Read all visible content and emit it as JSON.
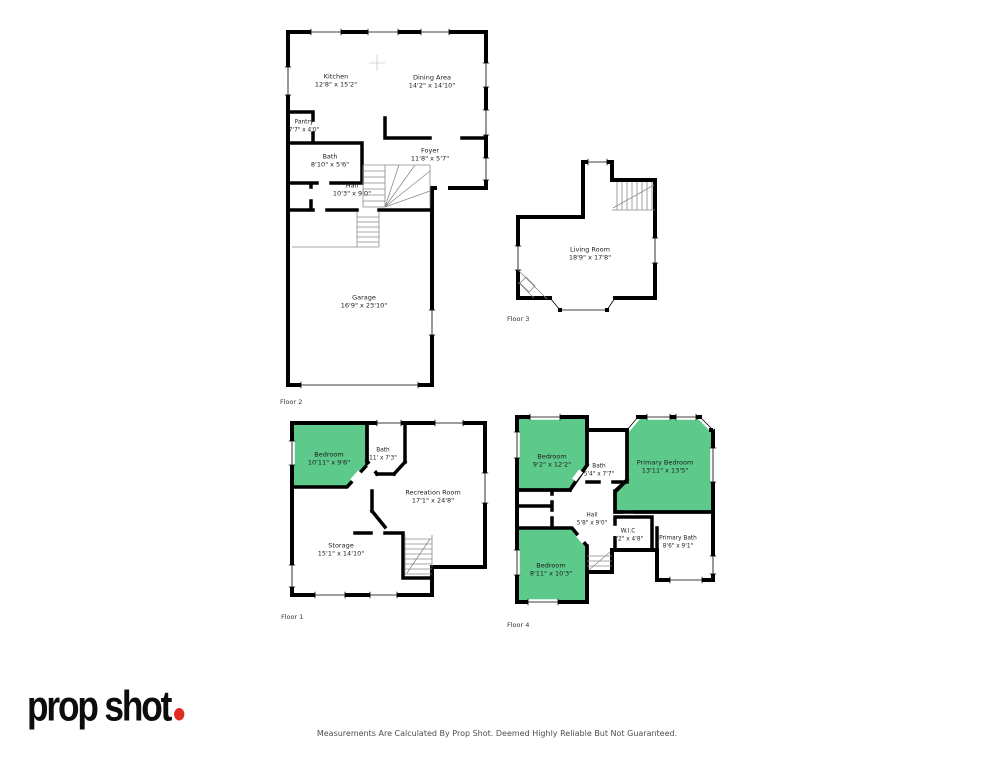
{
  "branding": {
    "logo": "prop shot",
    "dot_color": "#e02b22"
  },
  "footer": {
    "disclaimer": "Measurements Are Calculated By Prop Shot. Deemed Highly Reliable But Not Guaranteed."
  },
  "colors": {
    "room_highlight_green": "#5dc98a",
    "wall": "#000000"
  },
  "floors": {
    "floor2": {
      "label": "Floor 2",
      "rooms": {
        "kitchen": {
          "name": "Kitchen",
          "dims": "12'8\" x 15'2\""
        },
        "dining": {
          "name": "Dining Area",
          "dims": "14'2\" x 14'10\""
        },
        "pantry": {
          "name": "Pantry",
          "dims": "7'7\" x 4'0\""
        },
        "bath": {
          "name": "Bath",
          "dims": "8'10\" x 5'6\""
        },
        "foyer": {
          "name": "Foyer",
          "dims": "11'8\" x 5'7\""
        },
        "hall": {
          "name": "Hall",
          "dims": "10'3\" x 9'0\""
        },
        "garage": {
          "name": "Garage",
          "dims": "16'9\" x 23'10\""
        }
      }
    },
    "floor3": {
      "label": "Floor 3",
      "rooms": {
        "living": {
          "name": "Living Room",
          "dims": "18'9\" x 17'8\""
        }
      }
    },
    "floor1": {
      "label": "Floor 1",
      "rooms": {
        "bedroom": {
          "name": "Bedroom",
          "dims": "10'11\" x 9'6\""
        },
        "bath": {
          "name": "Bath",
          "dims": "11' x 7'3\""
        },
        "recreation": {
          "name": "Recreation Room",
          "dims": "17'1\" x 24'8\""
        },
        "storage": {
          "name": "Storage",
          "dims": "15'1\" x 14'10\""
        }
      }
    },
    "floor4": {
      "label": "Floor 4",
      "rooms": {
        "bedroom_top": {
          "name": "Bedroom",
          "dims": "9'2\" x 12'2\""
        },
        "bath": {
          "name": "Bath",
          "dims": "5'4\" x 7'7\""
        },
        "primary_bedroom": {
          "name": "Primary Bedroom",
          "dims": "13'11\" x 13'5\""
        },
        "hall": {
          "name": "Hall",
          "dims": "5'8\" x 9'0\""
        },
        "wic": {
          "name": "W.I.C",
          "dims": "5'2\" x 4'8\""
        },
        "primary_bath": {
          "name": "Primary Bath",
          "dims": "8'6\" x 9'1\""
        },
        "bedroom_bottom": {
          "name": "Bedroom",
          "dims": "8'11\" x 10'3\""
        }
      }
    }
  }
}
